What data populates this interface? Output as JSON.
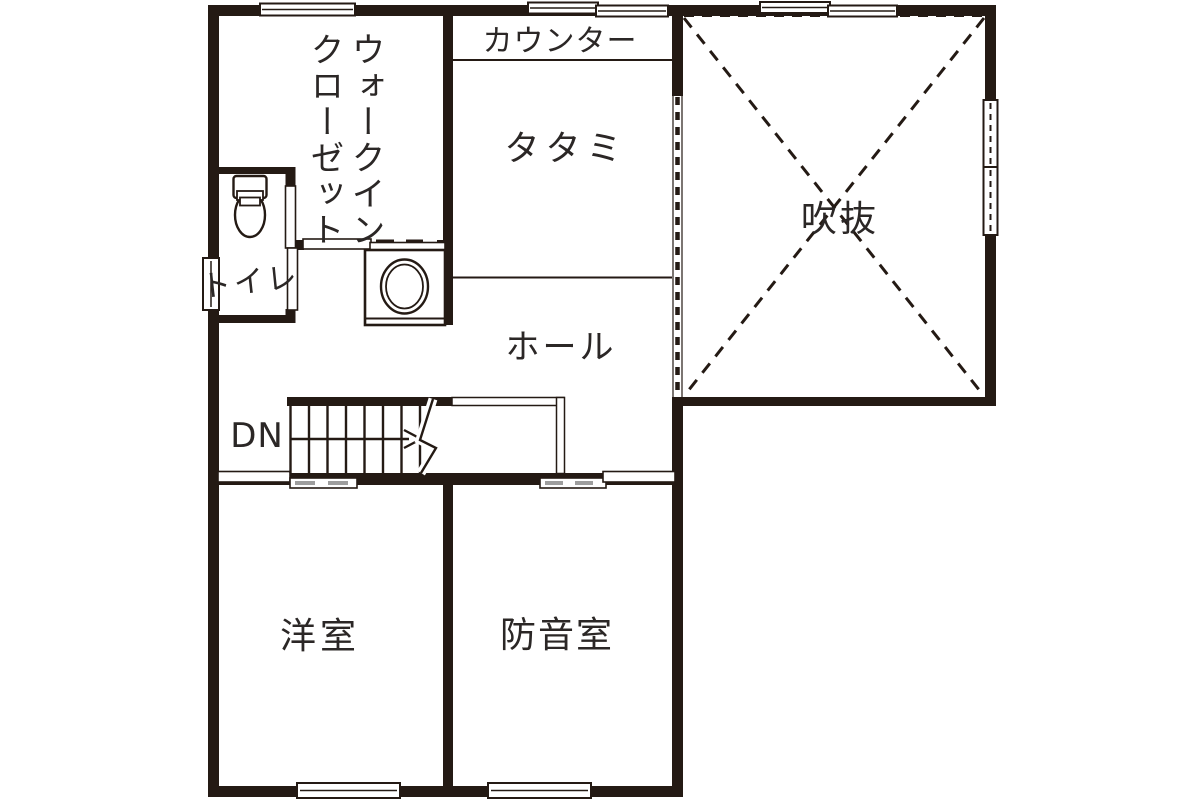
{
  "plan_type": "floor-plan-2f",
  "rooms": {
    "walk_in_closet": {
      "line1": "ウォークイン",
      "line2": "クローゼット"
    },
    "counter": {
      "label": "カウンター"
    },
    "tatami": {
      "label": "タタミ"
    },
    "void": {
      "label": "吹抜"
    },
    "toilet": {
      "label": "トイレ"
    },
    "hall": {
      "label": "ホール"
    },
    "western_room": {
      "label": "洋室"
    },
    "soundproof_room": {
      "label": "防音室"
    }
  },
  "stairs": {
    "direction_label": "DN"
  },
  "fixtures": [
    {
      "icon": "toilet-icon"
    },
    {
      "icon": "washbasin-icon"
    }
  ],
  "colors": {
    "wall": "#241a14",
    "text": "#2b2726",
    "background": "#ffffff"
  }
}
